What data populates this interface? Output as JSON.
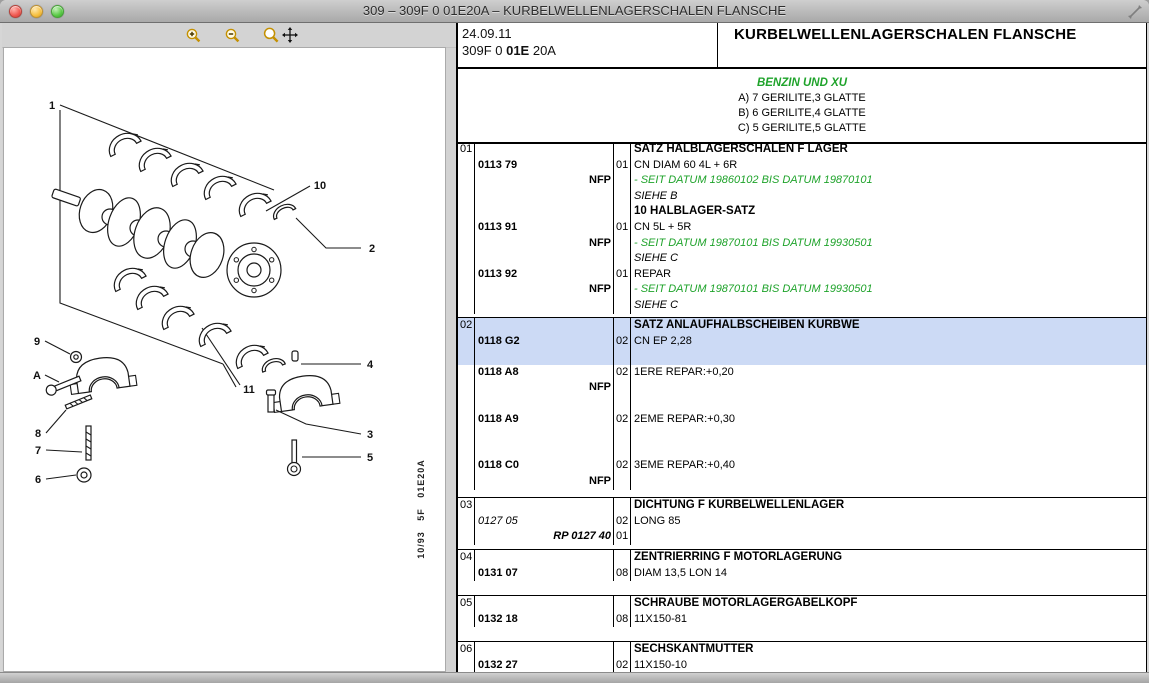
{
  "window": {
    "title": "309 – 309F 0 01E20A – KURBELWELLENLAGERSCHALEN FLANSCHE",
    "controls": [
      "close",
      "minimize",
      "zoom"
    ]
  },
  "colors": {
    "note_green": "#1fa32b",
    "highlight_blue": "#ccdaf5",
    "table_border": "#000000"
  },
  "toolbar": {
    "buttons": [
      "zoom-in",
      "zoom-out",
      "zoom-pan"
    ]
  },
  "diagram": {
    "plate_code": "10/93   5F   01E20A",
    "callouts": [
      {
        "label": "1",
        "x": 48,
        "y": 61
      },
      {
        "label": "10",
        "x": 316,
        "y": 141
      },
      {
        "label": "2",
        "x": 368,
        "y": 204
      },
      {
        "label": "9",
        "x": 33,
        "y": 297
      },
      {
        "label": "A",
        "x": 33,
        "y": 331
      },
      {
        "label": "8",
        "x": 34,
        "y": 389
      },
      {
        "label": "7",
        "x": 34,
        "y": 406
      },
      {
        "label": "6",
        "x": 34,
        "y": 435
      },
      {
        "label": "11",
        "x": 245,
        "y": 345
      },
      {
        "label": "4",
        "x": 366,
        "y": 320
      },
      {
        "label": "3",
        "x": 366,
        "y": 390
      },
      {
        "label": "5",
        "x": 366,
        "y": 413
      }
    ]
  },
  "panel_header": {
    "date": "24.09.11",
    "code_prefix": "309F 0 ",
    "code_bold": "01E",
    "code_suffix": " 20A",
    "title": "KURBELWELLENLAGERSCHALEN FLANSCHE"
  },
  "notes": {
    "engine_note": "BENZIN UND XU",
    "lines": [
      "A) 7 GERILITE,3 GLATTE",
      "B) 6 GERILITE,4 GLATTE",
      "C) 5 GERILITE,5 GLATTE"
    ]
  },
  "table": {
    "blocks": [
      {
        "item": "01",
        "rows": [
          {
            "desc": "SATZ HALBLAGERSCHALEN F LAGER",
            "descStyle": "bold"
          },
          {
            "ref": "0113 79",
            "qty": "01",
            "desc": "CN DIAM 60 4L + 6R"
          },
          {
            "ref": "NFP",
            "refAlign": "right",
            "desc": "- SEIT DATUM 19860102 BIS DATUM 19870101",
            "descStyle": "green"
          },
          {
            "desc": "SIEHE B",
            "descStyle": "italic"
          },
          {
            "desc": "10 HALBLAGER-SATZ",
            "descStyle": "bold"
          },
          {
            "ref": "0113 91",
            "qty": "01",
            "desc": "CN 5L + 5R"
          },
          {
            "ref": "NFP",
            "refAlign": "right",
            "desc": "- SEIT DATUM 19870101 BIS DATUM 19930501",
            "descStyle": "green"
          },
          {
            "desc": "SIEHE C",
            "descStyle": "italic"
          },
          {
            "ref": "0113 92",
            "qty": "01",
            "desc": "REPAR"
          },
          {
            "ref": "NFP",
            "refAlign": "right",
            "desc": "- SEIT DATUM 19870101 BIS DATUM 19930501",
            "descStyle": "green"
          },
          {
            "desc": "SIEHE C",
            "descStyle": "italic"
          }
        ]
      },
      {
        "item": "02",
        "rows": [
          {
            "desc": "SATZ ANLAUFHALBSCHEIBEN KURBWE",
            "descStyle": "bold",
            "hl": true
          },
          {
            "ref": "0118 G2",
            "qty": "02",
            "desc": "CN EP 2,28",
            "hl": true
          },
          {
            "hl": true
          },
          {
            "ref": "0118 A8",
            "qty": "02",
            "desc": "1ERE REPAR:+0,20"
          },
          {
            "ref": "NFP",
            "refAlign": "right"
          },
          {},
          {
            "ref": "0118 A9",
            "qty": "02",
            "desc": "2EME REPAR:+0,30"
          },
          {},
          {},
          {
            "ref": "0118 C0",
            "qty": "02",
            "desc": "3EME REPAR:+0,40"
          },
          {
            "ref": "NFP",
            "refAlign": "right"
          }
        ]
      },
      {
        "item": "03",
        "rows": [
          {
            "desc": "DICHTUNG F KURBELWELLENLAGER",
            "descStyle": "bold"
          },
          {
            "ref": "0127 05",
            "refStyle": "plain-italic",
            "qty": "02",
            "desc": "LONG 85"
          },
          {
            "ref": "RP 0127 40",
            "refStyle": "bold-italic",
            "refAlign": "right",
            "qty": "01"
          }
        ]
      },
      {
        "item": "04",
        "rows": [
          {
            "desc": "ZENTRIERRING F MOTORLAGERUNG",
            "descStyle": "bold"
          },
          {
            "ref": "0131 07",
            "qty": "08",
            "desc": "DIAM 13,5 LON 14"
          }
        ]
      },
      {
        "item": "05",
        "rows": [
          {
            "desc": "SCHRAUBE MOTORLAGERGABELKOPF",
            "descStyle": "bold"
          },
          {
            "ref": "0132 18",
            "qty": "08",
            "desc": "11X150-81"
          }
        ]
      },
      {
        "item": "06",
        "rows": [
          {
            "desc": "SECHSKANTMUTTER",
            "descStyle": "bold"
          },
          {
            "ref": "0132 27",
            "qty": "02",
            "desc": "11X150-10"
          },
          {
            "ref": "NFP",
            "refAlign": "right"
          }
        ]
      }
    ]
  }
}
